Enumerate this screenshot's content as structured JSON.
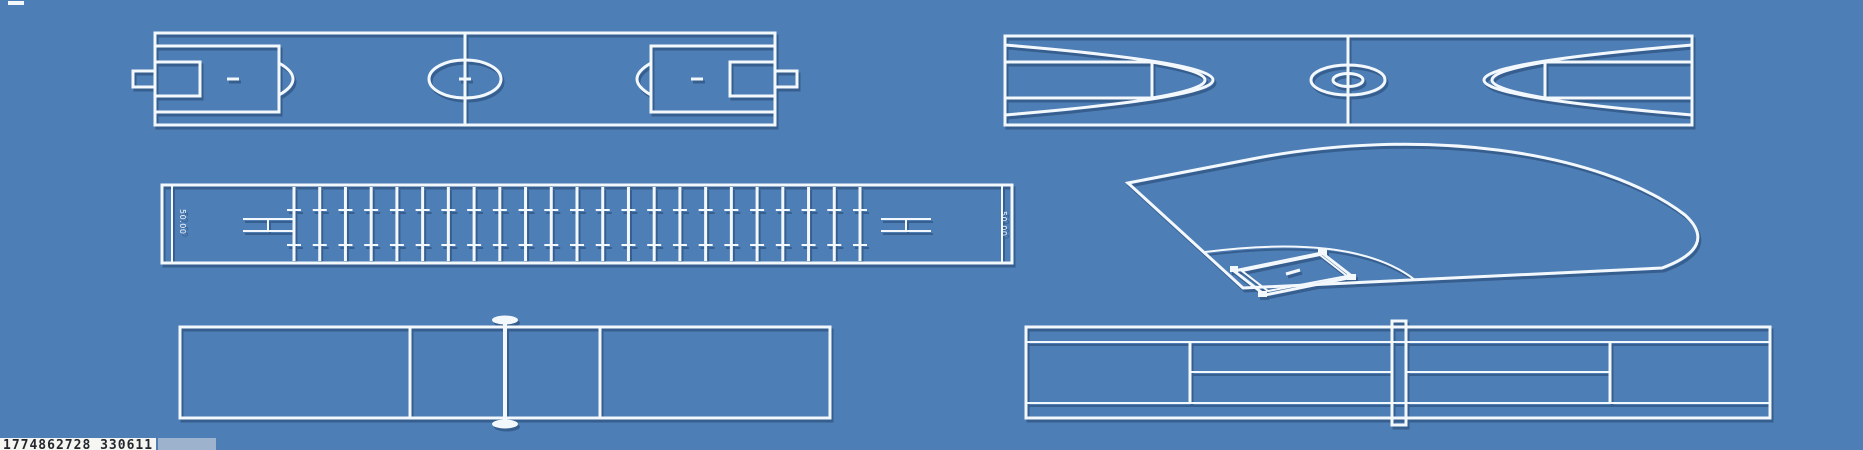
{
  "canvas": {
    "width": 1863,
    "height": 450
  },
  "colors": {
    "background": "#4d7eb6",
    "line": "#f3f8fd",
    "shadow": "rgba(27,56,94,0.45)",
    "watermark_bg": "#f5f5f2",
    "watermark_text": "#23282e",
    "watermark_box": "#9db3cd"
  },
  "facilities": {
    "soccer": {
      "name": "soccer-field"
    },
    "basketball": {
      "name": "basketball-court"
    },
    "pool": {
      "name": "swimming-pool",
      "lane_line_count": 23,
      "end_label_left": "50.00",
      "end_label_right": "50.00"
    },
    "baseball": {
      "name": "baseball-field"
    },
    "volleyball": {
      "name": "volleyball-court"
    },
    "tennis": {
      "name": "tennis-court"
    }
  },
  "watermark": {
    "text": "1774862728 330611"
  }
}
